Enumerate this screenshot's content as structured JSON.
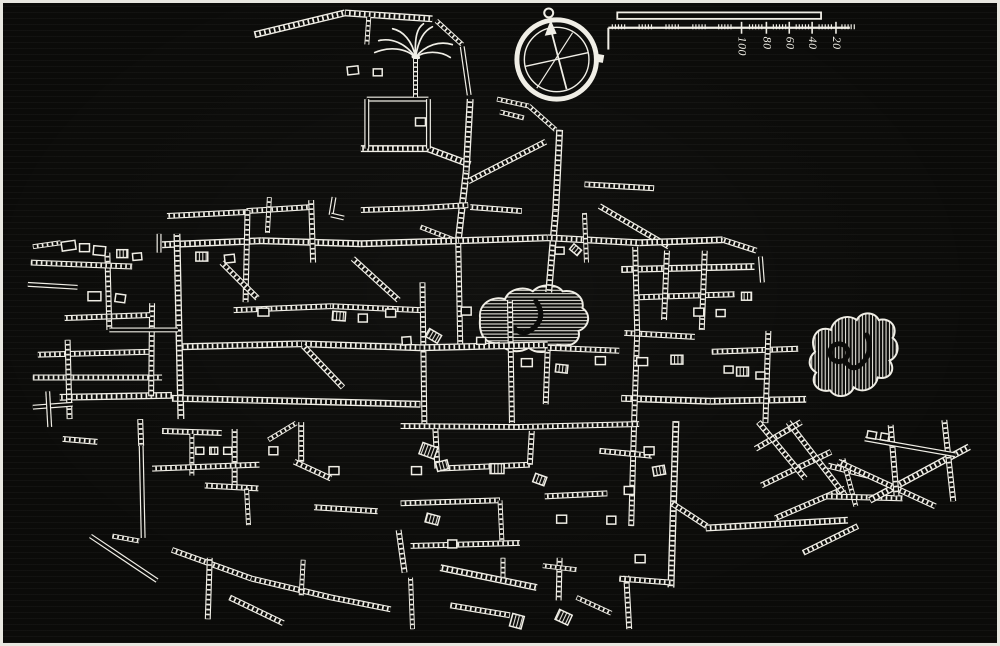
{
  "meta": {
    "description": "woodcut city street plan, white ink on black",
    "bg": "#0b0b09",
    "ink": "#f0eee6",
    "frame": "#e8e7e0"
  },
  "scale_bar": {
    "labels": [
      "100",
      "80",
      "60",
      "40",
      "20"
    ],
    "label_xs": [
      743,
      768,
      791,
      814,
      838
    ],
    "bar": {
      "x": 618,
      "y": 9.5,
      "w": 205,
      "h": 6.5
    },
    "ruler": {
      "x1": 609,
      "x2": 852,
      "y": 25,
      "drop_bottom": 47
    },
    "cluster_xs": [
      613,
      640,
      667,
      694,
      720,
      751,
      775,
      798,
      821,
      844
    ],
    "label_tick_top": 19,
    "label_tick_bottom": 31,
    "label_text_y": 34
  },
  "compass": {
    "cx": 557,
    "cy": 57,
    "outer_r": 40,
    "inner_r": 32.5,
    "needle": {
      "x1": 567,
      "y1": 87,
      "x2": 551,
      "y2": 26
    },
    "arrowhead": "551,17 545,33 557,31",
    "cross": {
      "x1": 525,
      "y1": 64,
      "x2": 589,
      "y2": 50
    },
    "diag2": {
      "x1": 537,
      "y1": 86,
      "x2": 573,
      "y2": 30
    },
    "ornament": {
      "cx": 549,
      "cy": 10,
      "r": 4.5
    },
    "tab": {
      "x": 596,
      "y": 51,
      "w": 9,
      "h": 8,
      "rot": 10
    }
  },
  "palm": {
    "x": 415,
    "y": 55,
    "trunk_bottom": 95,
    "fronds": [
      "M0,0 C-10,-15 -25,-20 -37,-17",
      "M0,0 C-10,-10 -27,-11 -41,-5",
      "M0,0 C-3,-17 -13,-27 -23,-29",
      "M0,0 C3,-19 9,-27 17,-31",
      "M0,0 C10,-13 25,-17 37,-13",
      "M0,0 C9,-7 25,-7 35,0",
      "M0,0 C-1,-22 2,-30 8,-34"
    ]
  },
  "blobs": [
    {
      "name": "hatched-area-center",
      "hatch": "h",
      "d": "M480,318 C478,304 492,295 505,299 C509,289 523,285 533,291 C541,283 557,283 563,291 C575,289 585,297 583,308 C592,314 590,327 579,331 C582,341 571,349 558,345 C552,353 537,355 529,348 C519,354 505,352 499,343 C487,345 478,337 480,318 Z",
      "inner": [
        {
          "type": "path",
          "d": "M536,301 q11,15 -2,27 q-11,10 -21,-1"
        }
      ]
    },
    {
      "name": "hatched-area-east",
      "hatch": "v",
      "d": "M817,352 C810,336 822,325 833,330 C835,319 849,313 859,320 C863,311 877,311 881,320 C893,317 901,328 895,338 C903,344 901,357 892,361 C899,371 891,381 880,378 C878,389 865,395 856,388 C852,398 838,400 832,391 C820,394 811,383 818,373 C809,367 810,358 817,352 Z",
      "inner": [
        {
          "type": "circle",
          "cx": 841,
          "cy": 353,
          "r": 9
        },
        {
          "type": "path",
          "d": "M869,335 q7,16 -4,28 q-9,10 -16,1"
        }
      ]
    }
  ],
  "streets": {
    "ladder": [
      [
        253,
        32,
        344,
        10
      ],
      [
        344,
        10,
        432,
        16
      ],
      [
        368,
        14,
        366,
        42,
        5
      ],
      [
        436,
        18,
        462,
        42,
        5
      ],
      [
        360,
        147,
        428,
        147
      ],
      [
        427,
        147,
        470,
        163
      ],
      [
        497,
        97,
        529,
        104,
        5
      ],
      [
        500,
        110,
        524,
        116,
        5
      ],
      [
        470,
        97,
        466,
        170
      ],
      [
        466,
        170,
        458,
        240
      ],
      [
        560,
        128,
        556,
        210
      ],
      [
        556,
        210,
        549,
        292
      ],
      [
        468,
        180,
        546,
        140,
        6
      ],
      [
        420,
        207,
        468,
        204,
        6
      ],
      [
        470,
        206,
        522,
        210,
        6
      ],
      [
        420,
        226,
        456,
        240,
        5
      ],
      [
        585,
        183,
        655,
        187,
        6
      ],
      [
        600,
        205,
        670,
        246,
        6
      ],
      [
        360,
        209,
        420,
        207,
        6
      ],
      [
        165,
        215,
        245,
        211,
        6
      ],
      [
        245,
        210,
        310,
        206,
        6
      ],
      [
        268,
        196,
        266,
        232,
        5
      ],
      [
        529,
        104,
        556,
        128,
        5
      ],
      [
        160,
        244,
        260,
        240
      ],
      [
        260,
        240,
        360,
        243
      ],
      [
        360,
        243,
        458,
        240
      ],
      [
        458,
        240,
        548,
        237
      ],
      [
        548,
        237,
        640,
        242
      ],
      [
        640,
        242,
        724,
        239
      ],
      [
        724,
        239,
        758,
        250,
        6
      ],
      [
        622,
        269,
        756,
        266
      ],
      [
        640,
        297,
        736,
        294,
        6
      ],
      [
        706,
        250,
        703,
        330,
        6
      ],
      [
        668,
        250,
        665,
        320,
        6
      ],
      [
        625,
        333,
        696,
        337,
        6
      ],
      [
        713,
        352,
        800,
        349,
        6
      ],
      [
        622,
        399,
        712,
        402
      ],
      [
        712,
        402,
        808,
        400
      ],
      [
        770,
        331,
        767,
        424,
        6
      ],
      [
        175,
        233,
        177,
        330
      ],
      [
        177,
        330,
        179,
        420
      ],
      [
        246,
        209,
        244,
        302,
        6
      ],
      [
        310,
        199,
        312,
        262,
        6
      ],
      [
        458,
        243,
        460,
        345,
        6
      ],
      [
        510,
        300,
        512,
        424,
        6
      ],
      [
        585,
        212,
        587,
        262,
        5
      ],
      [
        548,
        348,
        546,
        405,
        6
      ],
      [
        636,
        246,
        638,
        333,
        6
      ],
      [
        638,
        333,
        635,
        420,
        6
      ],
      [
        635,
        420,
        632,
        528,
        6
      ],
      [
        677,
        422,
        672,
        590
      ],
      [
        422,
        282,
        424,
        430,
        6
      ],
      [
        352,
        258,
        398,
        300,
        6
      ],
      [
        232,
        310,
        330,
        306,
        6
      ],
      [
        330,
        306,
        420,
        310,
        6
      ],
      [
        180,
        347,
        300,
        344
      ],
      [
        300,
        344,
        420,
        348
      ],
      [
        420,
        348,
        548,
        345
      ],
      [
        548,
        348,
        620,
        351,
        6
      ],
      [
        57,
        398,
        170,
        396
      ],
      [
        170,
        399,
        300,
        402
      ],
      [
        300,
        402,
        420,
        405
      ],
      [
        400,
        427,
        520,
        428,
        6
      ],
      [
        520,
        428,
        640,
        425,
        6
      ],
      [
        35,
        355,
        150,
        352,
        6
      ],
      [
        30,
        378,
        160,
        378,
        6
      ],
      [
        65,
        340,
        67,
        420,
        6
      ],
      [
        105,
        252,
        107,
        330,
        6
      ],
      [
        150,
        303,
        149,
        397,
        6
      ],
      [
        62,
        318,
        148,
        315,
        6
      ],
      [
        28,
        262,
        130,
        266,
        6
      ],
      [
        30,
        246,
        58,
        242,
        5
      ],
      [
        220,
        262,
        256,
        298,
        6
      ],
      [
        302,
        346,
        342,
        388,
        6
      ],
      [
        60,
        440,
        95,
        443,
        6
      ],
      [
        160,
        432,
        220,
        434,
        6
      ],
      [
        138,
        420,
        139,
        447,
        6
      ],
      [
        190,
        435,
        190,
        477,
        5
      ],
      [
        233,
        430,
        233,
        488,
        6
      ],
      [
        203,
        487,
        257,
        490,
        6
      ],
      [
        245,
        490,
        247,
        527,
        5
      ],
      [
        267,
        441,
        295,
        424,
        5
      ],
      [
        300,
        423,
        300,
        463,
        6
      ],
      [
        293,
        463,
        330,
        480,
        6
      ],
      [
        313,
        509,
        377,
        513,
        6
      ],
      [
        110,
        538,
        137,
        543,
        5
      ],
      [
        170,
        552,
        250,
        581,
        6
      ],
      [
        250,
        581,
        330,
        600,
        6
      ],
      [
        330,
        600,
        390,
        612,
        6
      ],
      [
        208,
        560,
        206,
        622,
        6
      ],
      [
        228,
        600,
        282,
        626,
        6
      ],
      [
        302,
        562,
        300,
        598,
        5
      ],
      [
        150,
        470,
        258,
        466,
        6
      ],
      [
        435,
        430,
        437,
        470,
        6
      ],
      [
        437,
        470,
        530,
        466,
        6
      ],
      [
        530,
        466,
        532,
        432,
        6
      ],
      [
        400,
        505,
        500,
        502,
        6
      ],
      [
        500,
        502,
        502,
        545,
        5
      ],
      [
        410,
        548,
        520,
        545,
        6
      ],
      [
        440,
        570,
        537,
        590
      ],
      [
        450,
        608,
        510,
        618,
        6
      ],
      [
        503,
        560,
        503,
        580,
        5
      ],
      [
        560,
        560,
        559,
        603,
        6
      ],
      [
        543,
        568,
        577,
        572,
        5
      ],
      [
        627,
        578,
        630,
        632,
        6
      ],
      [
        620,
        581,
        672,
        585,
        6
      ],
      [
        577,
        600,
        612,
        616,
        5
      ],
      [
        398,
        532,
        404,
        575,
        6
      ],
      [
        545,
        498,
        608,
        495,
        6
      ],
      [
        410,
        580,
        412,
        632,
        5
      ],
      [
        600,
        452,
        653,
        457,
        6
      ],
      [
        707,
        530,
        850,
        522
      ],
      [
        757,
        450,
        803,
        423,
        6
      ],
      [
        763,
        487,
        833,
        453,
        6
      ],
      [
        777,
        520,
        847,
        490,
        6
      ],
      [
        805,
        555,
        860,
        528,
        6
      ],
      [
        760,
        423,
        807,
        480,
        6
      ],
      [
        790,
        423,
        847,
        497,
        6
      ],
      [
        830,
        467,
        870,
        477,
        6
      ],
      [
        845,
        460,
        858,
        508,
        5
      ],
      [
        828,
        498,
        905,
        500,
        6
      ],
      [
        872,
        502,
        972,
        448
      ],
      [
        840,
        463,
        938,
        508,
        6
      ],
      [
        947,
        421,
        956,
        503,
        6
      ],
      [
        893,
        426,
        899,
        498,
        6
      ],
      [
        673,
        505,
        708,
        528,
        6
      ]
    ],
    "plain": [
      [
        366,
        97,
        428,
        97
      ],
      [
        366,
        97,
        366,
        147
      ],
      [
        428,
        97,
        428,
        147
      ],
      [
        462,
        44,
        469,
        93
      ],
      [
        157,
        233,
        157,
        252
      ],
      [
        762,
        256,
        764,
        282
      ],
      [
        107,
        330,
        176,
        330
      ],
      [
        25,
        284,
        75,
        287
      ],
      [
        30,
        408,
        70,
        405
      ],
      [
        45,
        392,
        47,
        428
      ],
      [
        139,
        447,
        141,
        540
      ],
      [
        88,
        538,
        155,
        583
      ],
      [
        867,
        440,
        958,
        456
      ],
      [
        333,
        196,
        330,
        214
      ],
      [
        330,
        214,
        343,
        217
      ]
    ]
  },
  "blocks": [
    [
      66,
      245,
      14,
      9,
      -8,
      "o"
    ],
    [
      82,
      247,
      10,
      8,
      0,
      "o"
    ],
    [
      97,
      250,
      12,
      9,
      5,
      "o"
    ],
    [
      120,
      253,
      11,
      8,
      0,
      "h"
    ],
    [
      135,
      256,
      9,
      7,
      -5,
      "o"
    ],
    [
      92,
      296,
      13,
      9,
      0,
      "o"
    ],
    [
      118,
      298,
      10,
      8,
      8,
      "o"
    ],
    [
      200,
      256,
      12,
      9,
      0,
      "h"
    ],
    [
      228,
      258,
      10,
      8,
      -6,
      "o"
    ],
    [
      262,
      312,
      11,
      8,
      0,
      "o"
    ],
    [
      338,
      316,
      13,
      9,
      4,
      "h"
    ],
    [
      362,
      318,
      9,
      8,
      0,
      "o"
    ],
    [
      390,
      313,
      10,
      8,
      0,
      "o"
    ],
    [
      406,
      341,
      9,
      8,
      -4,
      "o"
    ],
    [
      433,
      336,
      14,
      9,
      30,
      "h"
    ],
    [
      466,
      311,
      10,
      8,
      0,
      "o"
    ],
    [
      481,
      341,
      9,
      7,
      0,
      "o"
    ],
    [
      527,
      363,
      11,
      8,
      0,
      "o"
    ],
    [
      562,
      369,
      12,
      8,
      6,
      "h"
    ],
    [
      601,
      361,
      10,
      8,
      0,
      "o"
    ],
    [
      643,
      362,
      11,
      8,
      0,
      "o"
    ],
    [
      678,
      360,
      12,
      9,
      0,
      "h"
    ],
    [
      700,
      312,
      10,
      8,
      0,
      "o"
    ],
    [
      722,
      313,
      9,
      7,
      0,
      "o"
    ],
    [
      744,
      372,
      12,
      9,
      0,
      "h"
    ],
    [
      762,
      376,
      9,
      7,
      0,
      "o"
    ],
    [
      560,
      250,
      9,
      7,
      0,
      "o"
    ],
    [
      576,
      249,
      10,
      7,
      40,
      "h"
    ],
    [
      650,
      452,
      10,
      8,
      0,
      "o"
    ],
    [
      660,
      472,
      12,
      9,
      -10,
      "h"
    ],
    [
      630,
      492,
      10,
      8,
      0,
      "o"
    ],
    [
      612,
      522,
      9,
      8,
      0,
      "o"
    ],
    [
      562,
      521,
      10,
      8,
      0,
      "o"
    ],
    [
      540,
      481,
      12,
      9,
      20,
      "h"
    ],
    [
      432,
      521,
      13,
      9,
      15,
      "h"
    ],
    [
      452,
      546,
      9,
      8,
      0,
      "o"
    ],
    [
      416,
      472,
      10,
      8,
      0,
      "o"
    ],
    [
      333,
      472,
      10,
      8,
      0,
      "o"
    ],
    [
      272,
      452,
      9,
      8,
      0,
      "o"
    ],
    [
      198,
      452,
      8,
      7,
      0,
      "o"
    ],
    [
      212,
      452,
      8,
      7,
      0,
      "h"
    ],
    [
      226,
      452,
      8,
      7,
      0,
      "o"
    ],
    [
      874,
      436,
      9,
      7,
      10,
      "o"
    ],
    [
      887,
      438,
      8,
      7,
      10,
      "o"
    ],
    [
      641,
      561,
      10,
      8,
      0,
      "o"
    ],
    [
      517,
      624,
      12,
      13,
      15,
      "h"
    ],
    [
      564,
      620,
      14,
      11,
      25,
      "h"
    ],
    [
      352,
      68,
      11,
      8,
      -6,
      "o"
    ],
    [
      377,
      70,
      9,
      7,
      0,
      "o"
    ],
    [
      420,
      120,
      10,
      8,
      0,
      "o"
    ],
    [
      748,
      296,
      10,
      8,
      0,
      "h"
    ],
    [
      730,
      370,
      9,
      7,
      0,
      "o"
    ],
    [
      428,
      452,
      16,
      12,
      20,
      "h"
    ],
    [
      442,
      467,
      12,
      9,
      -15,
      "h"
    ],
    [
      497,
      470,
      14,
      10,
      0,
      "h"
    ]
  ]
}
